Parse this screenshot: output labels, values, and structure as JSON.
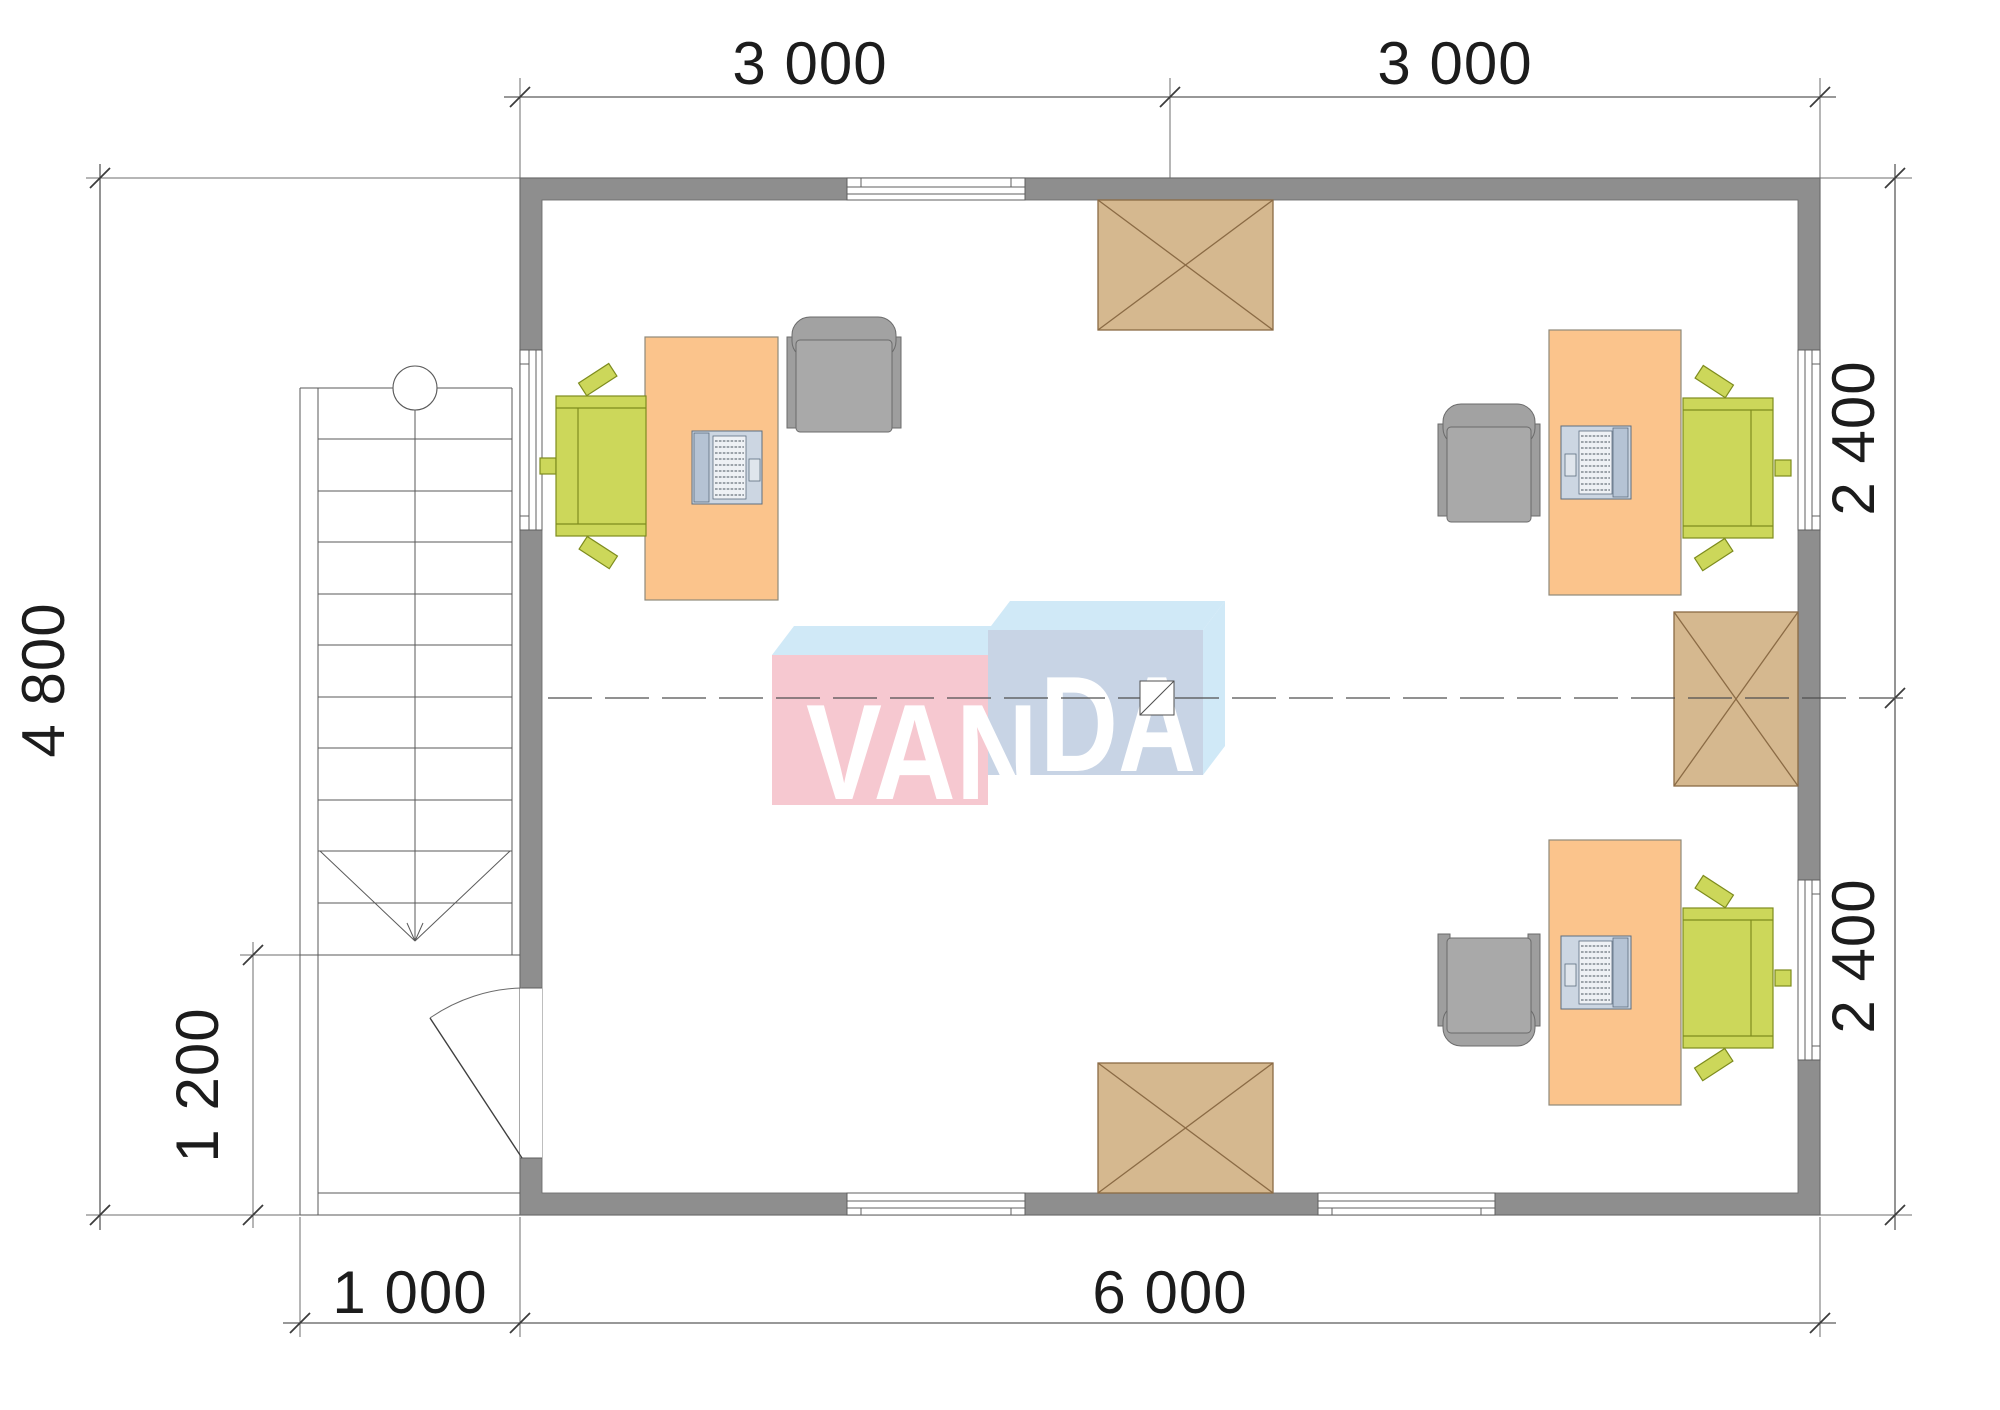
{
  "plan": {
    "dimensions": {
      "top_left": "3 000",
      "top_right": "3 000",
      "right_upper": "2 400",
      "right_lower": "2 400",
      "left_total": "4 800",
      "porch_height": "1 200",
      "bottom_porch": "1 000",
      "bottom_total": "6 000"
    },
    "watermark": {
      "full": "VANDA",
      "left_part": "VAN",
      "right_part": "DA"
    },
    "colors": {
      "wall": "#8e8e8e",
      "desk": "#fbc48c",
      "office_chair": "#ccd75a",
      "armchair": "#a9a9a9",
      "cabinet": "#d5b88f",
      "logo_pink": "#f6c8d0",
      "logo_blue_front": "#c8d4e5",
      "logo_light_blue": "#d0e9f7"
    }
  }
}
